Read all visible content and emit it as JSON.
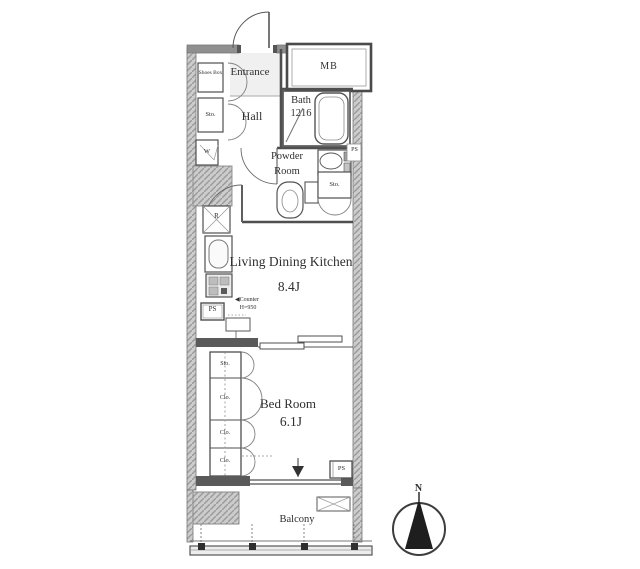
{
  "labels": {
    "entrance": "Entrance",
    "hall": "Hall",
    "shoes_box": "Shoes Box",
    "hall_storage": "Sto.",
    "washer": "W",
    "meter_box": "MB",
    "bath": "Bath",
    "bath_size": "1216",
    "powder_line1": "Powder",
    "powder_line2": "Room",
    "pipe_space_powder": "PS",
    "powder_storage": "Sto.",
    "range": "R",
    "pipe_space_kitchen": "PS",
    "counter_arrow": "◀",
    "counter_line1": "Counter",
    "counter_line2": "H=950",
    "ldk": "Living Dining Kitchen",
    "ldk_size": "8.4J",
    "bedroom": "Bed Room",
    "bedroom_size": "6.1J",
    "bedroom_storage": "Sto.",
    "closet_1": "Clo.",
    "closet_2": "Clo.",
    "closet_3": "Clo.",
    "pipe_space_bedroom": "PS",
    "balcony": "Balcony",
    "compass_north": "N"
  },
  "colors": {
    "line": "#4a4a4a",
    "wall_fill": "#c6c6c6",
    "text": "#2f2f2f",
    "background": "#ffffff"
  }
}
